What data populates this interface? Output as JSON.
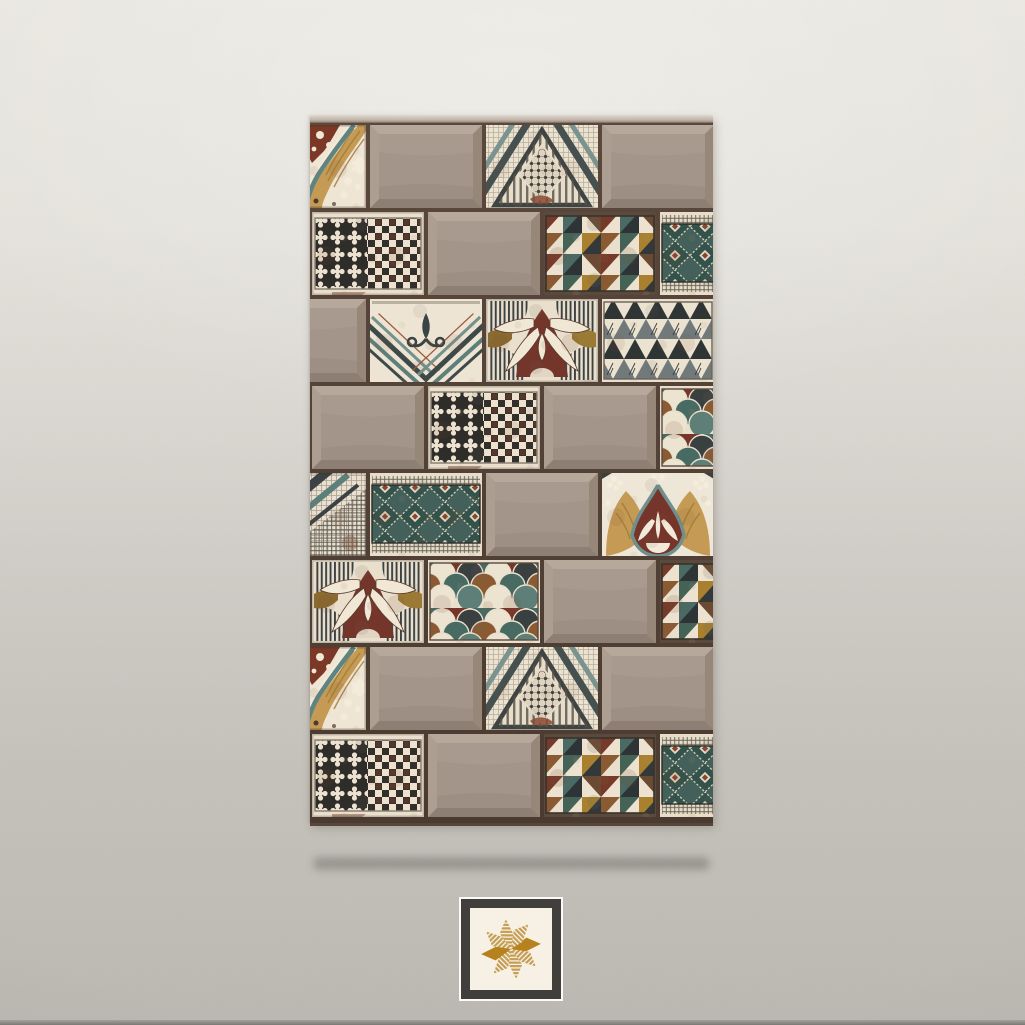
{
  "meta": {
    "description": "Product photo: decorative patchwork mosaic wall-tile panel mounted on a textured grey plaster wall, soft shadow below, framed eight-point star brand emblem centered near the bottom",
    "text_content": "none — image contains no readable text"
  },
  "wall": {
    "top_color": "#eae8e1",
    "middle_color": "#cecbc5",
    "bottom_color": "#bbb8b1",
    "baseboard_color": "#7b7973"
  },
  "panel": {
    "left": 310,
    "top": 116,
    "width": 403,
    "height": 707,
    "cap_color": "#c2b5a9",
    "grout_color": "#4a3a30",
    "tile_width": 116,
    "row_height": 87,
    "gap": 4,
    "rows": [
      {
        "offset": -58,
        "tiles": [
          "agate",
          "plain",
          "chevron",
          "plain"
        ]
      },
      {
        "offset": 0,
        "tiles": [
          "quatrefoil-checker",
          "plain",
          "tri-checks",
          "teal-ikat"
        ]
      },
      {
        "offset": -58,
        "tiles": [
          "plain",
          "fleur-arrow",
          "palmette",
          "tri-bw"
        ]
      },
      {
        "offset": 0,
        "tiles": [
          "plain",
          "quatrefoil-checker",
          "plain",
          "scales"
        ]
      },
      {
        "offset": -58,
        "tiles": [
          "diag-hatch",
          "teal-ikat",
          "plain",
          "arch-ornate"
        ]
      },
      {
        "offset": 0,
        "tiles": [
          "palmette",
          "scales",
          "plain",
          "tri-checks"
        ]
      },
      {
        "offset": -58,
        "tiles": [
          "agate",
          "plain",
          "chevron",
          "plain"
        ]
      },
      {
        "offset": 0,
        "tiles": [
          "quatrefoil-checker",
          "plain",
          "tri-checks",
          "teal-ikat"
        ]
      }
    ]
  },
  "palette": {
    "plain_taupe": "#a5968a",
    "cream": "#ece3d1",
    "charcoal": "#33383a",
    "teal": "#4a6a63",
    "teal_dark": "#32524b",
    "maroon_rust": "#763a2b",
    "brown": "#8a5a33",
    "gold_ochre": "#a9812e",
    "tan_marble": "#c49a55"
  },
  "shadow": {
    "left": 313,
    "top": 857,
    "width": 397,
    "height": 13
  },
  "logo": {
    "left": 459,
    "top": 897,
    "size": 104,
    "outer_border_color": "#fbfaf6",
    "frame_color": "#403f3b",
    "inner_color": "#f6f1e4",
    "star_gold": "#b5821e",
    "star_stripe_gold": "#c79b4b",
    "petal_count": 8,
    "solid_petals": [
      0,
      4
    ]
  }
}
